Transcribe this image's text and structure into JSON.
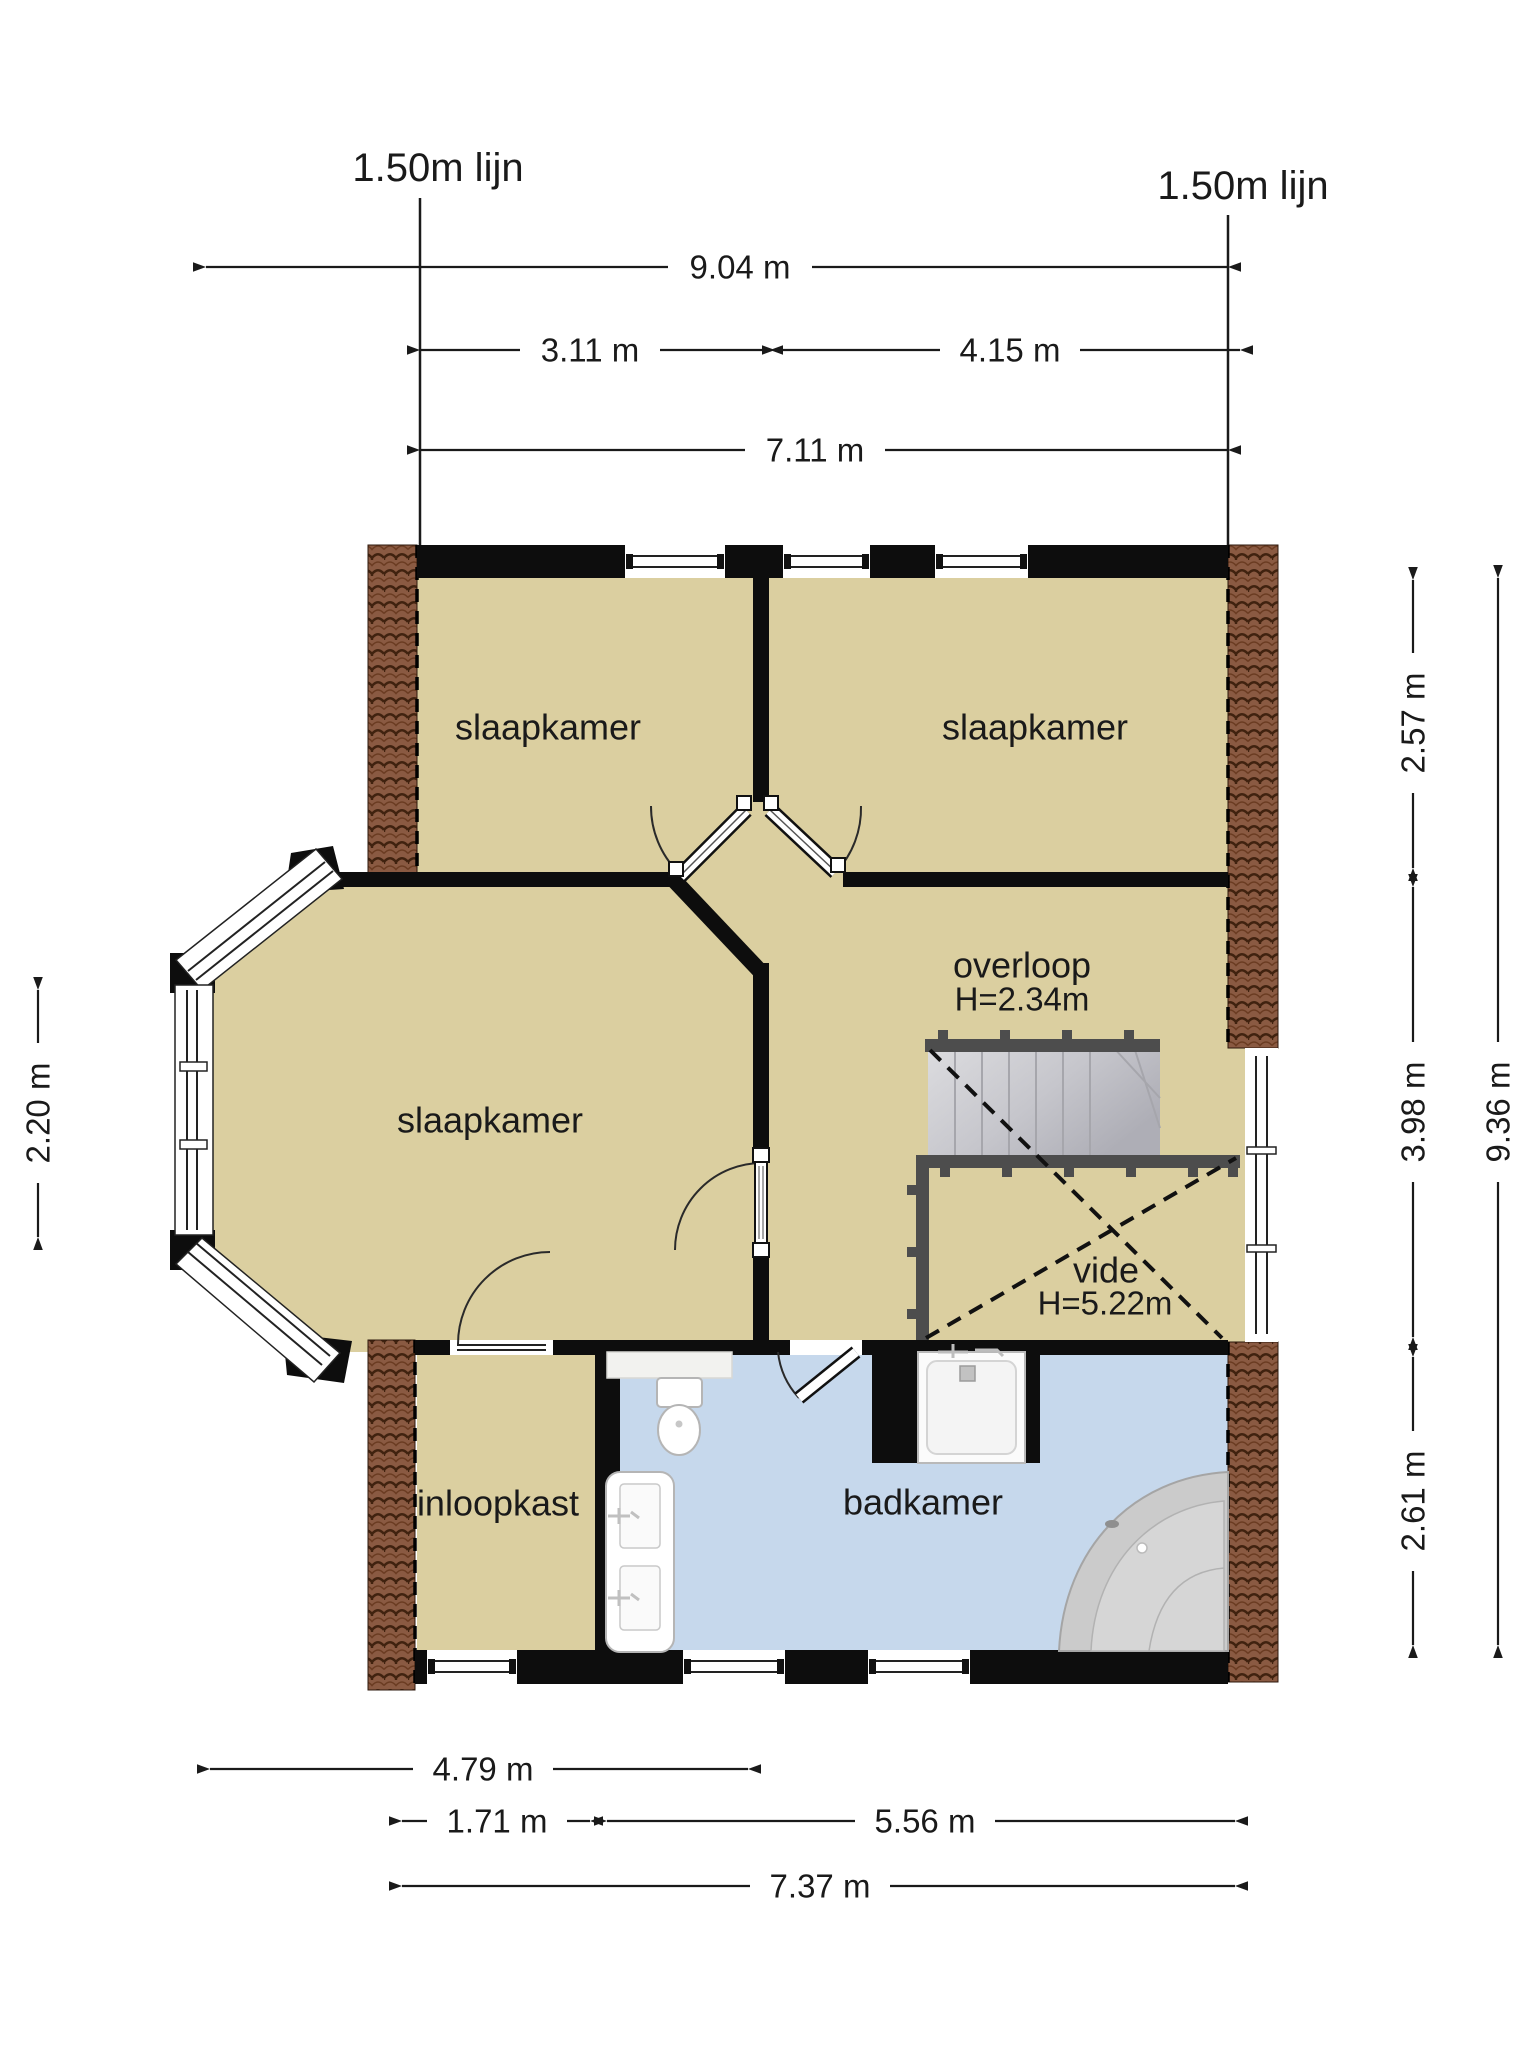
{
  "floorplan": {
    "type": "upper-floor plan (verdieping)",
    "reference_lines": {
      "left": "1.50m lijn",
      "right": "1.50m lijn"
    },
    "dimensions_top": {
      "total": "9.04 m",
      "left_span": "3.11 m",
      "right_span": "4.15 m",
      "interior": "7.11 m"
    },
    "dimensions_left": {
      "bay_window": "2.20 m"
    },
    "dimensions_right": {
      "upper": "2.57 m",
      "middle": "3.98 m",
      "lower": "2.61 m",
      "total": "9.36 m"
    },
    "dimensions_bottom": {
      "bedroom": "4.79 m",
      "closet": "1.71 m",
      "bathroom": "5.56 m",
      "interior_total": "7.37 m"
    },
    "rooms": {
      "bedroom_top_left": {
        "label": "slaapkamer"
      },
      "bedroom_top_right": {
        "label": "slaapkamer"
      },
      "bedroom_left": {
        "label": "slaapkamer"
      },
      "landing": {
        "label": "overloop",
        "ceiling_height": "H=2.34m"
      },
      "void_space": {
        "label": "vide",
        "clear_height": "H=5.22m"
      },
      "walk_in_closet": {
        "label": "inloopkast"
      },
      "bathroom": {
        "label": "badkamer"
      }
    },
    "colors": {
      "room_floor": "#dbcfa0",
      "bathroom_floor": "#c6d8ec",
      "roof_tiles": "#8a5a42",
      "walls": "#0d0d0d",
      "stairs": "#c9c9cf"
    }
  }
}
